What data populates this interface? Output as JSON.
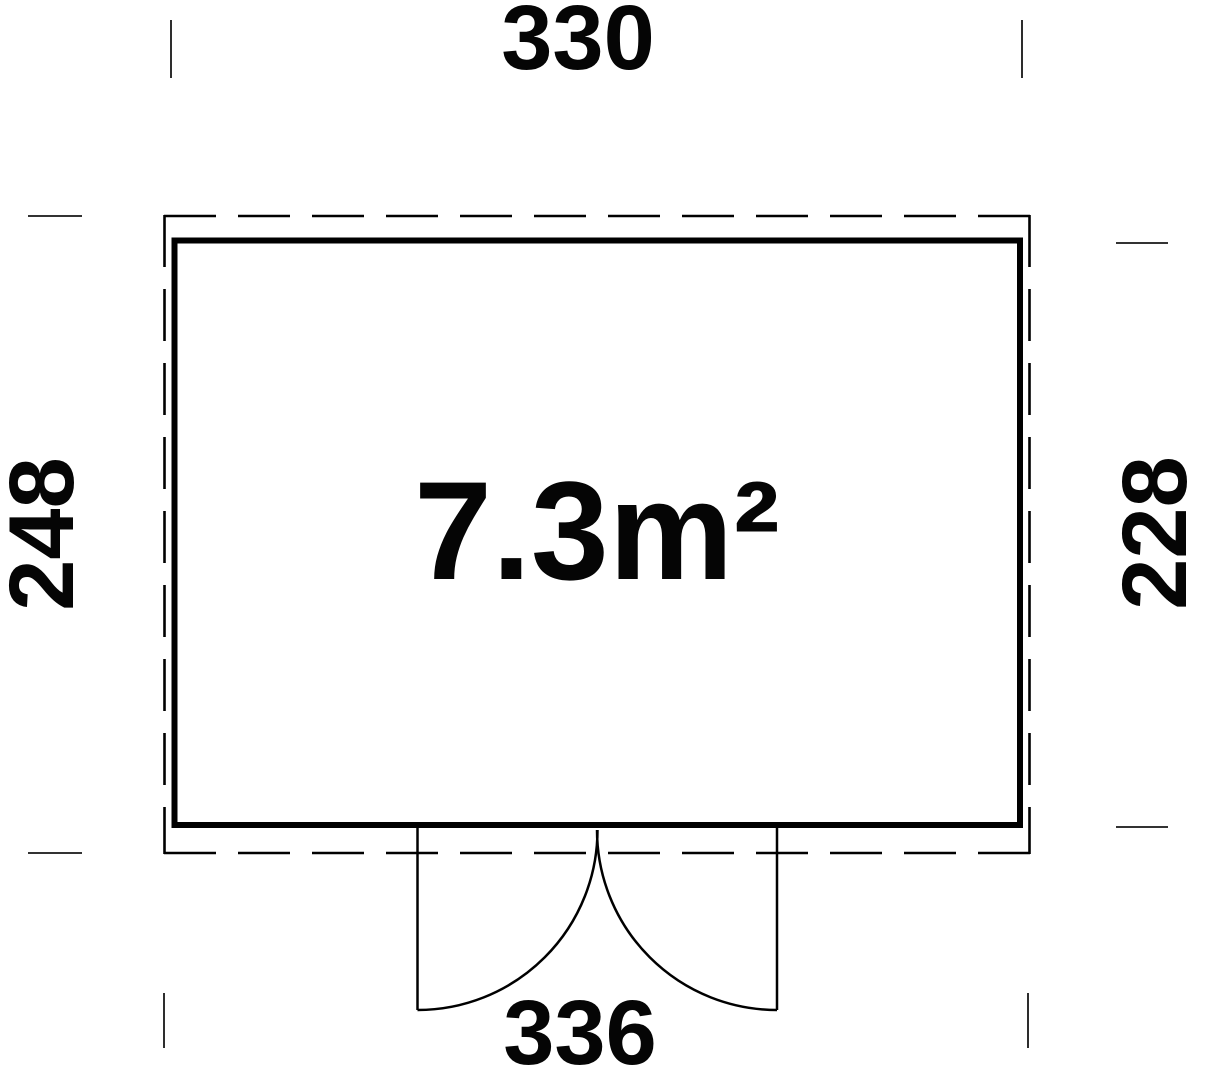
{
  "colors": {
    "line": "#000000",
    "tick": "#161616",
    "background": "#ffffff"
  },
  "floor_plan": {
    "area_label": "7.3m²",
    "dim_top": "330",
    "dim_bottom": "336",
    "dim_left": "248",
    "dim_right": "228"
  }
}
